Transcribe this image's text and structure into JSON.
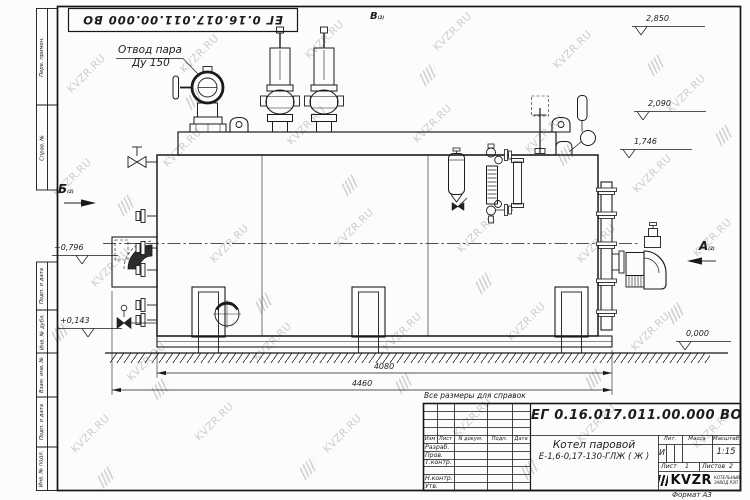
{
  "watermark": {
    "text": "KVZR.RU"
  },
  "doc": {
    "number": "ЕГ 0.16.017.011.00.000 ВО",
    "note": "Все размеры для справок",
    "format": "Формат А3"
  },
  "margin": {
    "labels": [
      "Перв. примен.",
      "Справ. №",
      "Подп. и дата",
      "Инв. № дубл.",
      "Взам. инв. №",
      "Подп. и дата",
      "Инв. № подл."
    ]
  },
  "callouts": {
    "steam_outlet": {
      "line1": "Отвод пара",
      "line2": "Ду 150"
    },
    "views": {
      "a": "А",
      "b": "Б",
      "v": "В",
      "sheet_ref": "(2)"
    },
    "levels": {
      "v2850": "2,850",
      "v2090": "2,090",
      "v1746": "1,746",
      "v0796": "+0,796",
      "v0143": "+0,143",
      "v0000": "0,000"
    },
    "dims": {
      "shell": "4080",
      "overall": "4460"
    }
  },
  "title_block": {
    "number": "ЕГ 0.16.017.011.00.000 ВО",
    "product": "Котел паровой",
    "model": "Е-1,6-0,17-130-ГЛЖ ( Ж )",
    "col_headers": [
      "Изм",
      "Лист",
      "N докум.",
      "Подп.",
      "Дата"
    ],
    "row_labels": [
      "Разраб.",
      "Пров.",
      "Т.контр.",
      "",
      "Н.контр.",
      "Утв."
    ],
    "lit_label": "Лит.",
    "mass_label": "Масса",
    "scale_label": "Масштаб",
    "lit_value": "И",
    "scale_value": "1:15",
    "sheet_label": "Лист",
    "sheet_num": "1",
    "sheets_label": "Листов",
    "sheets_num": "2",
    "brand": "KVZR",
    "brand_sub1": "КОТЕЛЬНЫЙ",
    "brand_sub2": "ЗАВОД РЭП"
  }
}
